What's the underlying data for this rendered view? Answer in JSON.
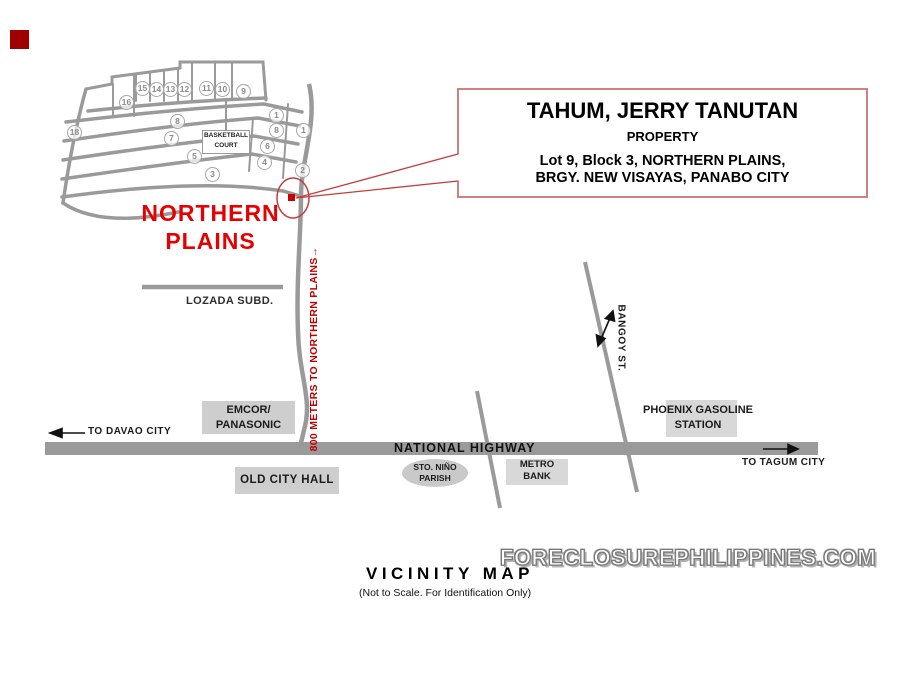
{
  "map": {
    "subdivision_name": "NORTHERN\nPLAINS",
    "basketball_court": "BASKETBALL\nCOURT",
    "lot_numbers": [
      "16",
      "15",
      "14",
      "13",
      "12",
      "11",
      "10",
      "9",
      "1",
      "18",
      "8",
      "7",
      "8",
      "1",
      "6",
      "5",
      "4",
      "3",
      "2"
    ],
    "lozada_label": "LOZADA SUBD.",
    "road_note": "800 METERS TO NORTHERN PLAINS→",
    "bangoy_street": "BANGOY ST.",
    "highway_label": "NATIONAL HIGHWAY",
    "to_davao": "TO DAVAO CITY",
    "to_tagum": "TO TAGUM CITY",
    "landmarks": {
      "emcor": "EMCOR/\nPANASONIC",
      "old_city_hall": "OLD CITY HALL",
      "sto_nino": "STO. NIÑO\nPARISH",
      "metro_bank": "METRO\nBANK",
      "phoenix": "PHOENIX GASOLINE\nSTATION"
    }
  },
  "callout": {
    "owner": "TAHUM, JERRY TANUTAN",
    "type": "PROPERTY",
    "address": "Lot 9, Block 3, NORTHERN PLAINS,\nBRGY. NEW VISAYAS, PANABO CITY"
  },
  "footer": {
    "watermark": "FORECLOSUREPHILIPPINES.COM",
    "title": "VICINITY MAP",
    "subtitle": "(Not to Scale. For Identification Only)"
  },
  "colors": {
    "road_gray": "#9a9a9a",
    "accent_red": "#e60000",
    "dark_red": "#c00000",
    "callout_border": "#d08080",
    "marker_red": "#cc0000"
  }
}
